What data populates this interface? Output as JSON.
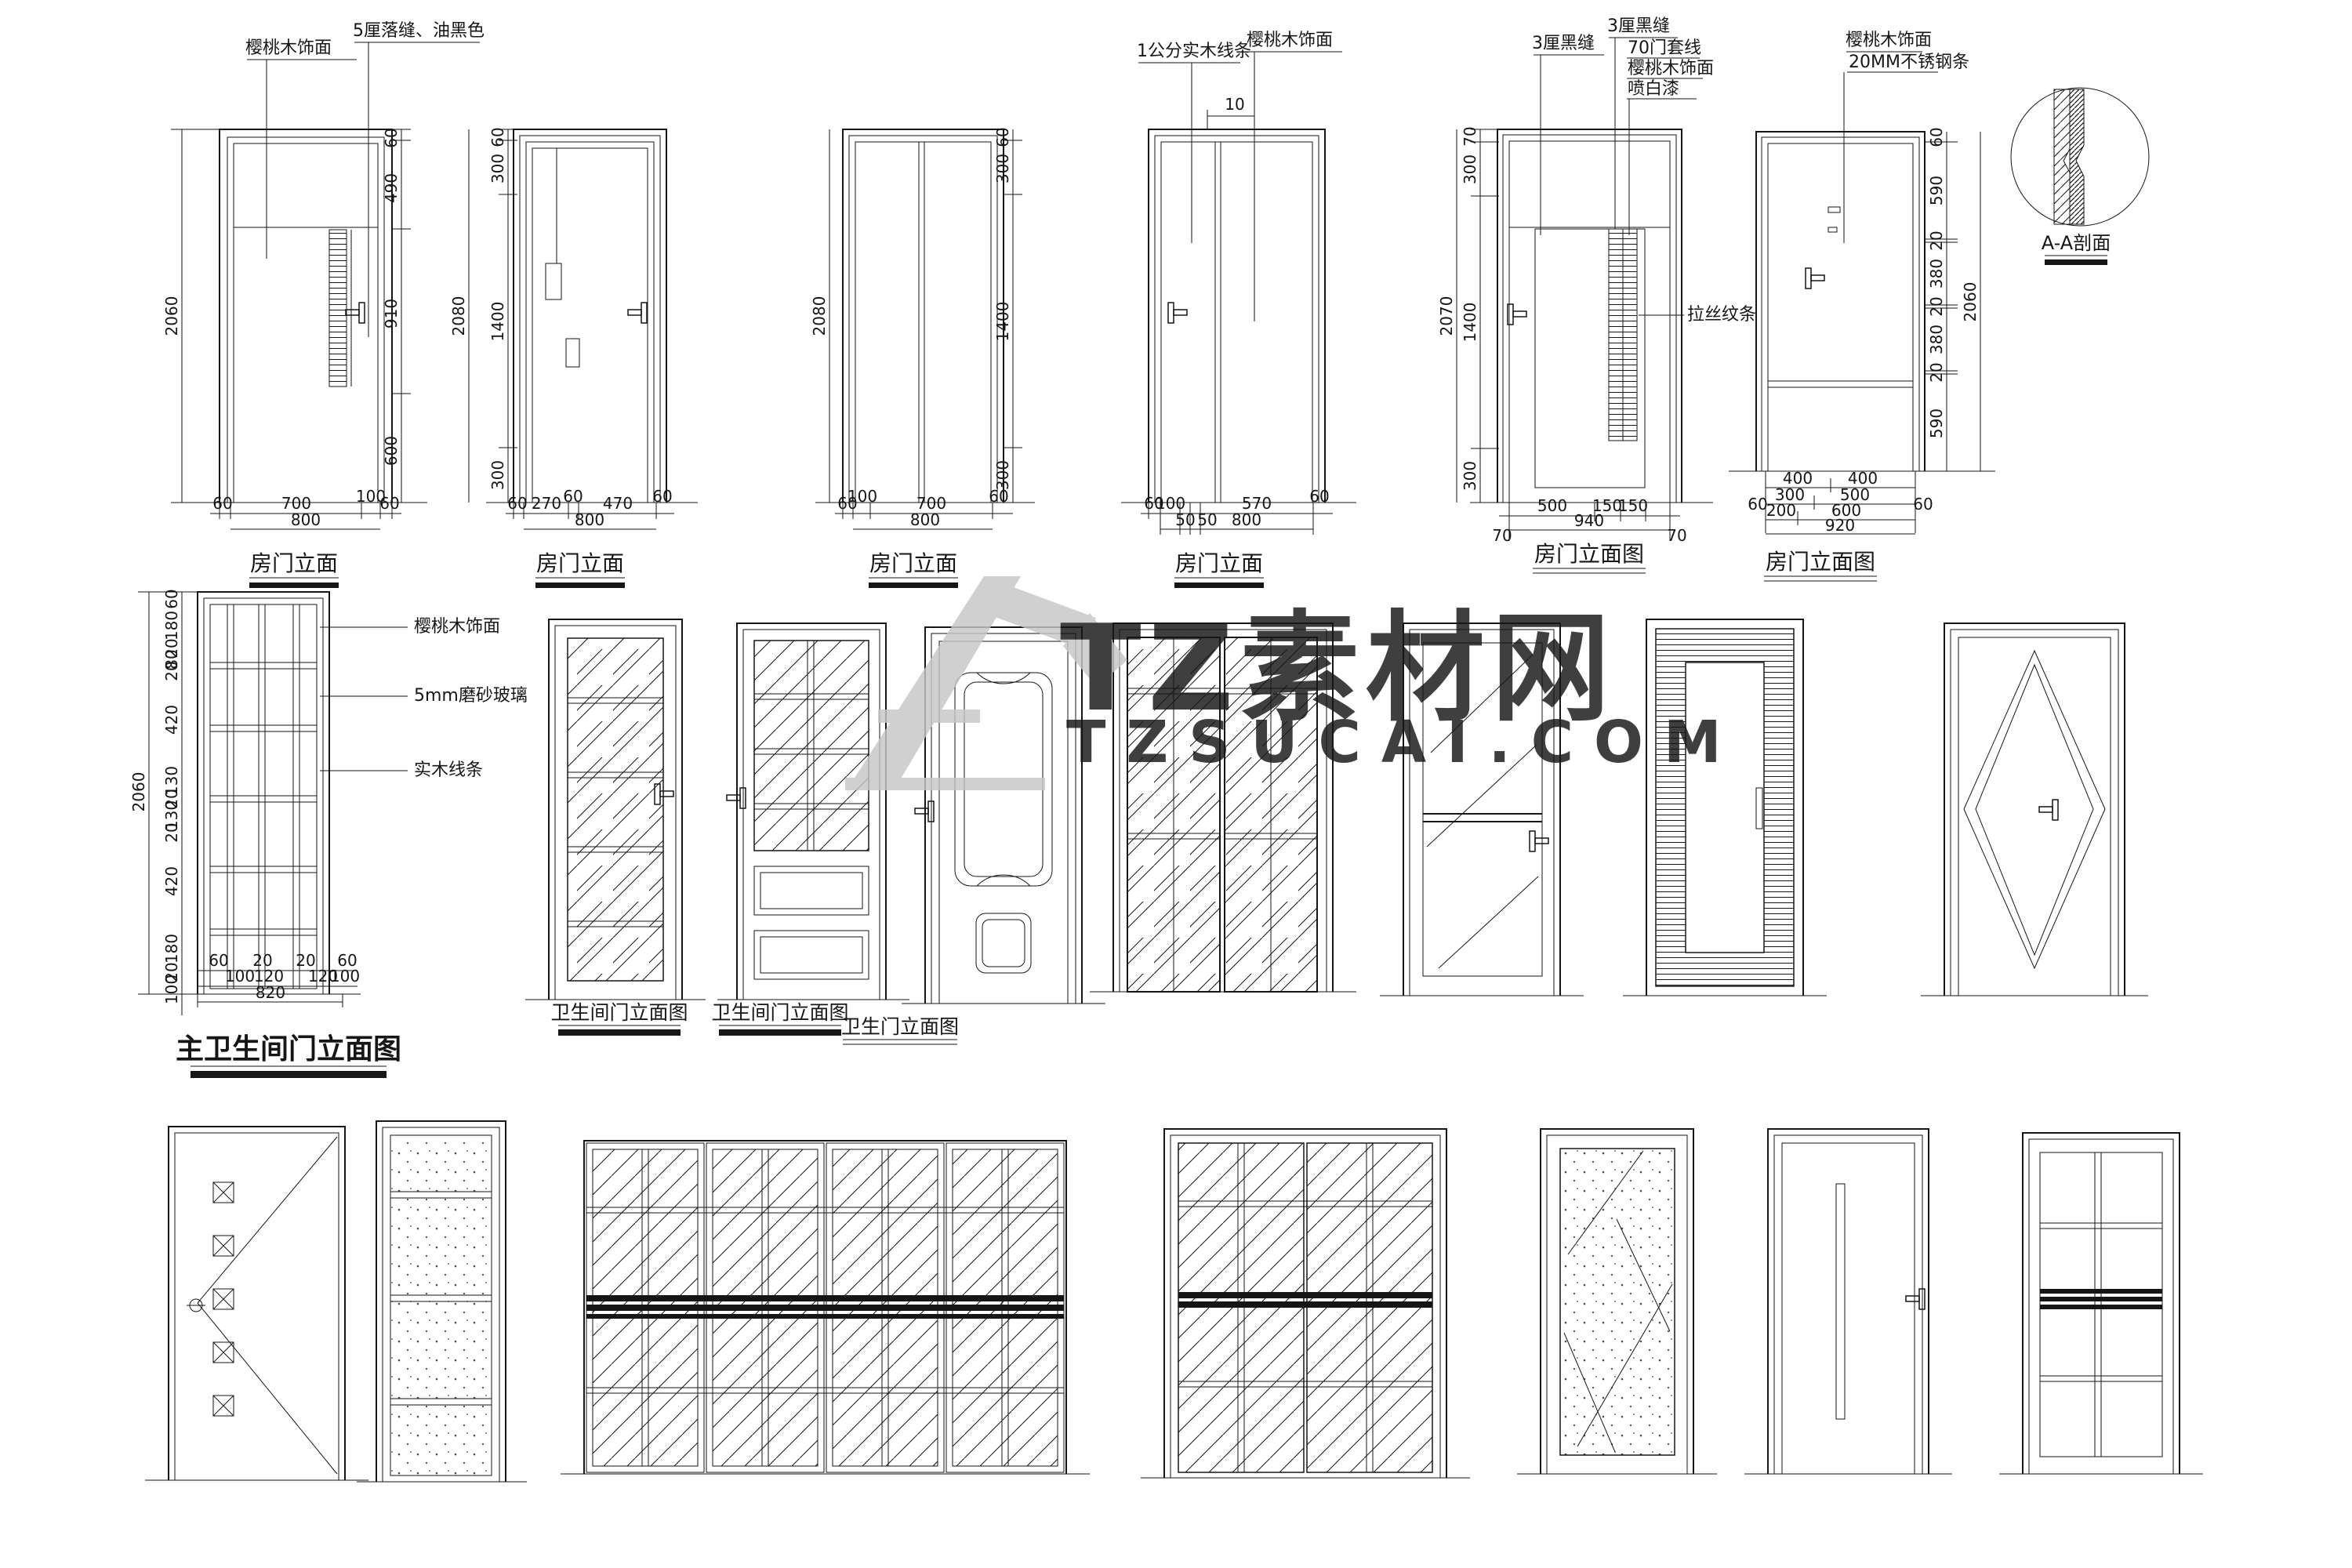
{
  "watermark": {
    "brand": "TZ素材网",
    "domain": "TZSUCAI.COM",
    "color": "#c6c6c6"
  },
  "colors": {
    "line": "#161616",
    "background": "#ffffff",
    "watermark": "#c6c6c6"
  },
  "row1": {
    "section_title": "A-A剖面",
    "doors": [
      {
        "title": "房门立面",
        "callout1": "樱桃木饰面",
        "callout2": "5厘落缝、油黑色",
        "overall": "2060",
        "side": [
          "60",
          "490",
          "910",
          "600"
        ],
        "bottom1": [
          "60",
          "700",
          "100",
          "60"
        ],
        "total": "800"
      },
      {
        "title": "房门立面",
        "overall": "2080",
        "side": [
          "60",
          "300",
          "1400",
          "300"
        ],
        "bottom1": [
          "60",
          "270",
          "60",
          "470",
          "60"
        ],
        "total": "800"
      },
      {
        "title": "房门立面",
        "overall": "2080",
        "side": [
          "60",
          "300",
          "1400",
          "300"
        ],
        "bottom1": [
          "60",
          "100",
          "700",
          "60"
        ],
        "total": "800"
      },
      {
        "title": "房门立面",
        "callout1": "1公分实木线条",
        "callout2": "樱桃木饰面",
        "top_dim": "10",
        "overall": "2080",
        "bottom1": [
          "60",
          "100",
          "570",
          "60"
        ],
        "bottom2": [
          "50",
          "50"
        ],
        "total": "800"
      },
      {
        "title": "房门立面图",
        "callout1": "3厘黑缝",
        "callout2": "3厘黑缝",
        "callout3": "70门套线",
        "callout4": "樱桃木饰面",
        "callout5": "喷白漆",
        "callout6": "拉丝纹条",
        "overall": "2070",
        "side": [
          "70",
          "300",
          "1400",
          "300"
        ],
        "bottom1": [
          "500",
          "150",
          "150"
        ],
        "total": "940",
        "flank": [
          "70",
          "70"
        ]
      },
      {
        "title": "房门立面图",
        "callout1": "樱桃木饰面",
        "callout2": "20MM不锈钢条",
        "overall": "2060",
        "side": [
          "60",
          "590",
          "20",
          "380",
          "20",
          "380",
          "20",
          "590"
        ],
        "bottom1": [
          "400",
          "400"
        ],
        "bottom2": [
          "300",
          "500"
        ],
        "bottom3": [
          "200",
          "600"
        ],
        "total": "920",
        "flank": [
          "60",
          "60"
        ]
      }
    ]
  },
  "row2": {
    "master": {
      "title": "主卫生间门立面图",
      "callout1": "樱桃木饰面",
      "callout2": "5mm磨砂玻璃",
      "callout3": "实木线条",
      "overall": "2060",
      "side": [
        "60",
        "180",
        "20",
        "80",
        "20",
        "420",
        "130",
        "20",
        "130",
        "20",
        "420",
        "180",
        "20",
        "100"
      ],
      "bottom1": [
        "60",
        "20",
        "20",
        "60"
      ],
      "bottom2": [
        "100",
        "120",
        "120",
        "100"
      ],
      "total": "820"
    },
    "title_b": "卫生间门立面图",
    "title_c": "卫生间门立面图",
    "title_d": "卫生门立面图"
  }
}
